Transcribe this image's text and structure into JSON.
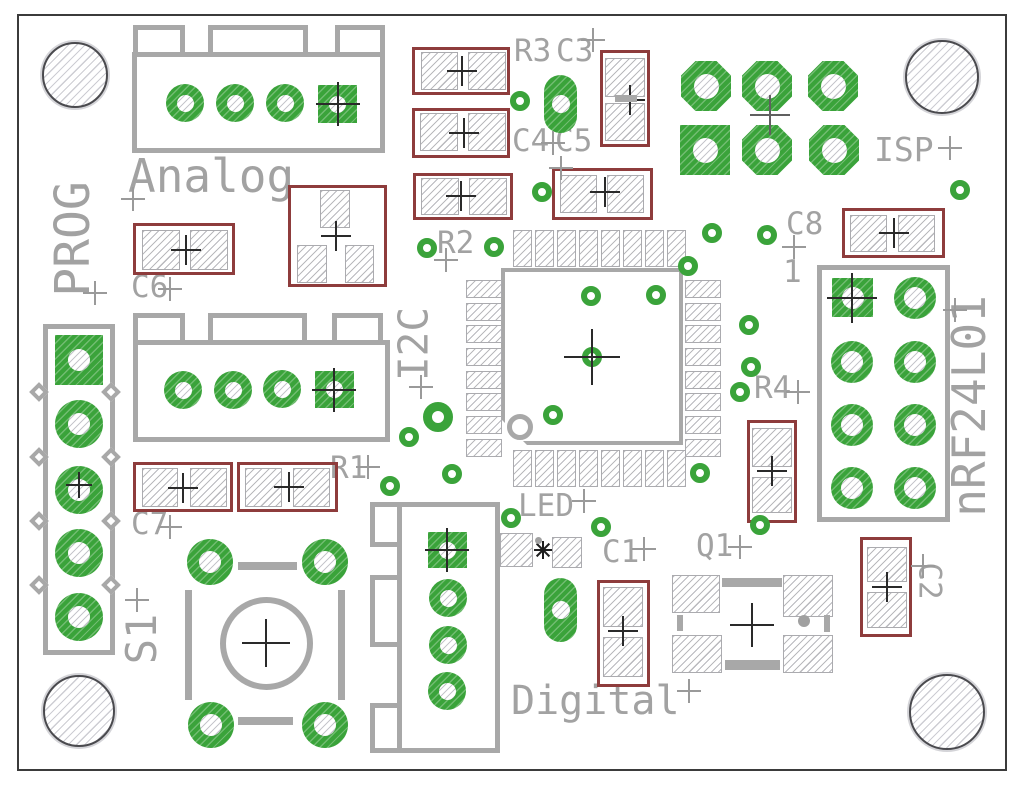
{
  "board": {
    "connectors": {
      "analog": "Analog",
      "prog": "PROG",
      "i2c": "I2C",
      "isp": "ISP",
      "digital": "Digital",
      "nrf24l01": "nRF24L01"
    },
    "components": {
      "s1": "S1",
      "r1": "R1",
      "r2": "R2",
      "r3": "R3",
      "r4": "R4",
      "c1": "C1",
      "c2": "C2",
      "c3": "C3",
      "c4": "C4",
      "c5": "C5",
      "c6": "C6",
      "c7": "C7",
      "c8": "C8",
      "led": "LED",
      "q1": "Q1"
    },
    "markers": {
      "pin1": "1"
    },
    "colors": {
      "pad_green": "#3aa33a",
      "silkscreen_gray": "#a8a8a8",
      "courtyard_red": "#8e3c3c",
      "board_outline": "#3b3b3b"
    }
  }
}
